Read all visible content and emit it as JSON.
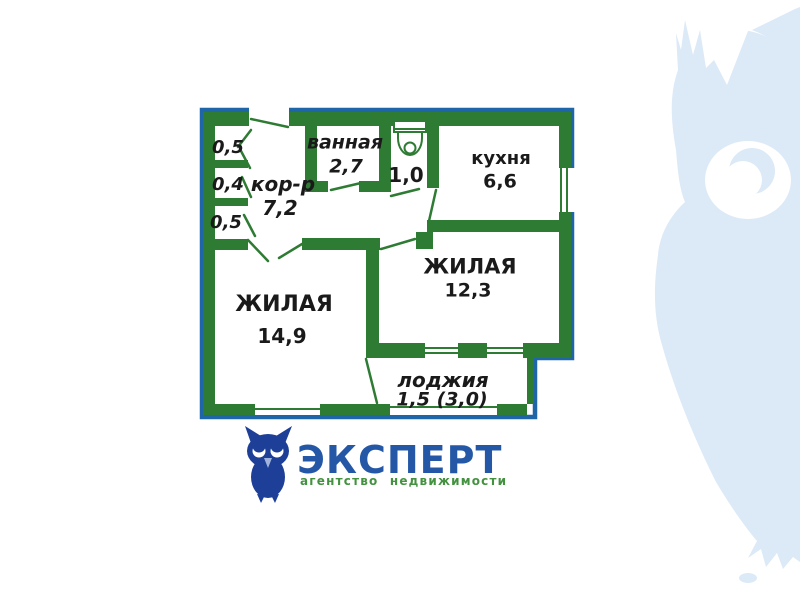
{
  "floorplan": {
    "rooms": {
      "closet_top": "0,5",
      "closet_middle": "0,4",
      "closet_bottom": "0,5",
      "corridor_name": "кор-р",
      "corridor_area": "7,2",
      "bathroom_name": "ванная",
      "bathroom_area": "2,7",
      "wc_area": "1,0",
      "kitchen_name": "кухня",
      "kitchen_area": "6,6",
      "living_right_name": "ЖИЛАЯ",
      "living_right_area": "12,3",
      "living_left_name": "ЖИЛАЯ",
      "living_left_area": "14,9",
      "loggia_name": "лоджия",
      "loggia_area": "1,5 (3,0)"
    },
    "colors": {
      "wall_green": "#2e7b34",
      "outline_blue": "#1f66a8",
      "label_text": "#1a1a1a"
    }
  },
  "logo": {
    "title": "ЭКСПЕРТ",
    "subtitle": "агентство недвижимости",
    "colors": {
      "title_blue": "#2458a6",
      "subtitle_green": "#43923f",
      "owl_navy": "#1e3f97"
    }
  },
  "watermark": {
    "color": "#dce9f7"
  }
}
